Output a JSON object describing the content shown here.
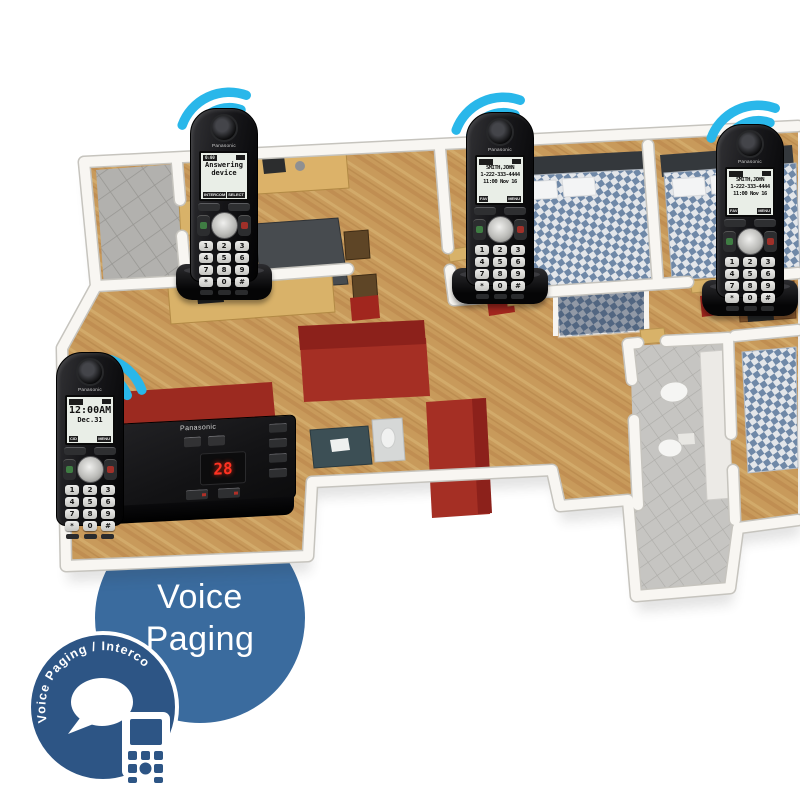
{
  "brand": "Panasonic",
  "colors": {
    "wifi": "#29b7ea",
    "voice_circle": "#3a6b9e",
    "badge": "#2d5585",
    "led": "#ff3222"
  },
  "keypad": [
    "1",
    "2",
    "3",
    "4",
    "5",
    "6",
    "7",
    "8",
    "9",
    "*",
    "0",
    "#"
  ],
  "handsets": [
    {
      "location": "kitchen",
      "display": {
        "status_left": "0:00",
        "lines": [
          "Answering",
          "device"
        ],
        "soft_left": "INTERCOM",
        "soft_right": "SELECT"
      }
    },
    {
      "location": "bedroom-1",
      "display": {
        "lines": [
          "SMITH,JOHN",
          "1-222-333-4444",
          "11:00 Nov 16"
        ],
        "soft_left": "FAV",
        "soft_right": "MENU"
      }
    },
    {
      "location": "bedroom-2",
      "display": {
        "lines": [
          "SMITH,JOHN",
          "1-222-333-4444",
          "11:00 Nov 16"
        ],
        "soft_left": "FAV",
        "soft_right": "MENU"
      }
    },
    {
      "location": "living-room-base",
      "display": {
        "lines": [
          "12:00AM",
          "Dec.31"
        ],
        "soft_left": "CID",
        "soft_right": "MENU"
      }
    }
  ],
  "base_unit": {
    "brand": "Panasonic",
    "message_count": "28"
  },
  "voice_paging": {
    "line1": "Voice",
    "line2": "Paging"
  },
  "intercom_badge": {
    "label": "Voice Paging / Intercom"
  }
}
